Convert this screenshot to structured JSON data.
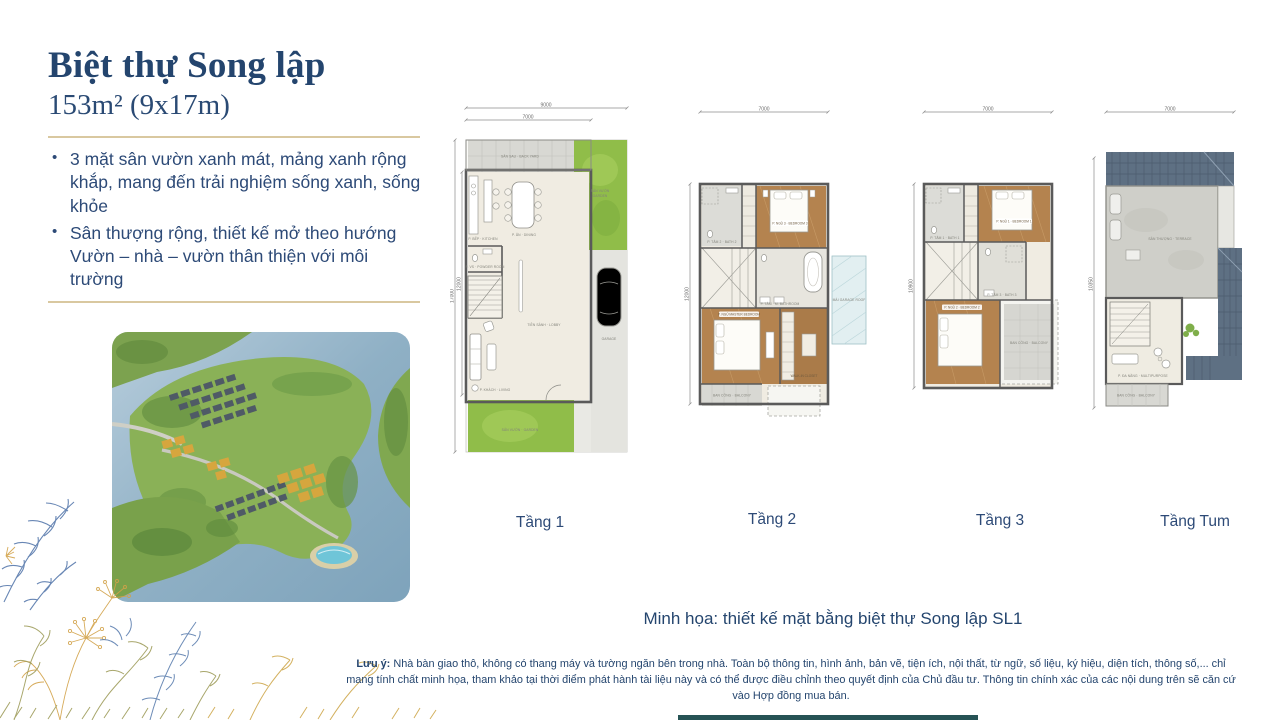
{
  "colors": {
    "navy": "#24456e",
    "tan": "#d9c8a0",
    "teal": "#265355",
    "wood": "#b4834f",
    "grass": "#90bd49",
    "roof": "#5e7083"
  },
  "header": {
    "title": "Biệt thự Song lập",
    "subtitle": "153m² (9x17m)"
  },
  "features": {
    "item1": "3 mặt sân vườn xanh mát, mảng xanh rộng khắp, mang đến trải nghiệm sống xanh, sống khỏe",
    "item2": "Sân thượng rộng, thiết kế mở theo hướng Vườn – nhà – vườn thân thiện với môi trường"
  },
  "plans": {
    "f1": {
      "label": "Tầng 1",
      "dim_w_outer": "9000",
      "dim_w_inner": "7000",
      "dim_h_outer": "17000",
      "dim_h_inner": "12000",
      "rooms": {
        "backyard": "SÂN SAU · BACK YARD",
        "garden_side": "SÂN VƯỜN",
        "garden_side2": "GARDEN",
        "kitchen": "P. BẾP · KITCHEN",
        "dining": "P. ĂN · DINING",
        "powder": "P. VS · POWDER ROOM",
        "lobby": "TIỀN SẢNH · LOBBY",
        "living": "P. KHÁCH · LIVING",
        "garage": "GARAGE",
        "garden_front": "SÂN VƯỜN · GARDEN"
      }
    },
    "f2": {
      "label": "Tầng 2",
      "dim_w": "7000",
      "dim_h": "12000",
      "rooms": {
        "bath2": "P. TẮM 2 · BATH 2",
        "bed3": "P. NGỦ 3 · BEDROOM 3",
        "masterbath": "P. TẮM · M. BATHROOM",
        "master": "P. NGỦ MASTER BEDROOM",
        "wic": "WALK-IN CLOSET",
        "balcony": "BAN CÔNG · BALCONY",
        "garage_roof": "MÁI GARAGE ROOF"
      }
    },
    "f3": {
      "label": "Tầng 3",
      "dim_w": "7000",
      "dim_h": "10900",
      "rooms": {
        "bath1": "P. TẮM 1 · BATH 1",
        "bed1": "P. NGỦ 1 · BEDROOM 1",
        "bath3": "P. TẮM 3 · BATH 3",
        "bed2": "P. NGỦ 2 · BEDROOM 2",
        "balcony": "BAN CÔNG · BALCONY"
      }
    },
    "tum": {
      "label": "Tầng Tum",
      "dim_w": "7000",
      "dim_h": "10350",
      "rooms": {
        "terrace": "SÂN THƯỢNG · TERRACE",
        "multi": "P. ĐA NĂNG · MULTIPURPOSE",
        "balcony": "BAN CÔNG · BALCONY"
      }
    }
  },
  "caption": "Minh họa: thiết kế mặt bằng biệt thự Song lập SL1",
  "note": {
    "label": "Lưu ý:",
    "text": " Nhà bàn giao thô, không có thang máy và tường ngăn bên trong nhà. Toàn bộ thông tin, hình ảnh, bản vẽ, tiện ích, nội thất, từ ngữ, số liệu, ký hiệu, diện tích, thông số,... chỉ mang tính chất minh họa, tham khảo tại thời điểm phát hành tài liệu này và có thể được điều chỉnh theo quyết định của Chủ đầu tư. Thông tin chính xác của các nội dung trên sẽ căn cứ vào Hợp đồng mua bán."
  }
}
